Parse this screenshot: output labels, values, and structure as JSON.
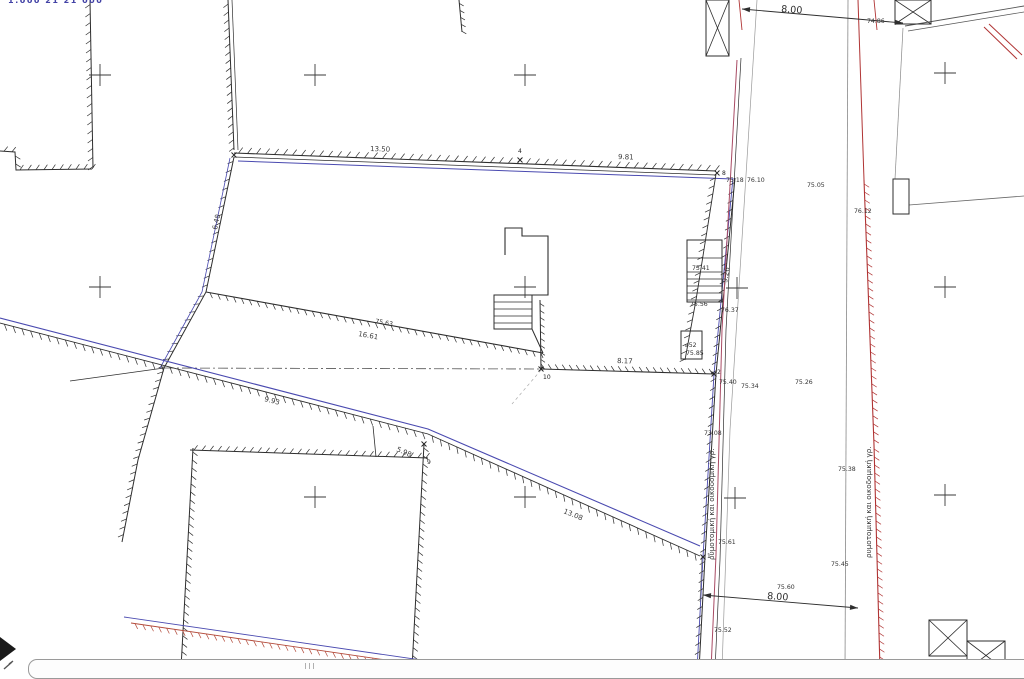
{
  "canvas": {
    "width": 1024,
    "height": 670,
    "background": "#ffffff"
  },
  "corner_text": "1:000 21 21 000",
  "street_labels": {
    "left": "ρυμοτομική και οικοδομική γρ.",
    "right": "ρυμοτομική και οικοδομική γρ."
  },
  "colors": {
    "ink": "#2e2e2e",
    "boundary_blue": "#4a4ab0",
    "road_magenta": "#a84a63",
    "edge_red": "#b03434",
    "bottom_red": "#b34a3a",
    "faint_gray": "#999999",
    "cross_gray": "#3a3a3a"
  },
  "labels": [
    {
      "text": "13.50",
      "x": 370,
      "y": 151,
      "rot": 2,
      "kind": "dim"
    },
    {
      "text": "9.81",
      "x": 618,
      "y": 159,
      "rot": 2,
      "kind": "dim"
    },
    {
      "text": "6.40",
      "x": 217,
      "y": 230,
      "rot": -78,
      "kind": "dim"
    },
    {
      "text": "9.26",
      "x": 727,
      "y": 283,
      "rot": -80,
      "kind": "dim"
    },
    {
      "text": "16.61",
      "x": 358,
      "y": 336,
      "rot": 10,
      "kind": "dim"
    },
    {
      "text": "8.17",
      "x": 617,
      "y": 363,
      "rot": 2,
      "kind": "dim"
    },
    {
      "text": "9.93",
      "x": 264,
      "y": 401,
      "rot": 14,
      "kind": "dim"
    },
    {
      "text": "5.98",
      "x": 396,
      "y": 451,
      "rot": 23,
      "kind": "dim"
    },
    {
      "text": "13.08",
      "x": 563,
      "y": 513,
      "rot": 22,
      "kind": "dim"
    },
    {
      "text": "8.00",
      "x": 781,
      "y": 12,
      "rot": 4,
      "kind": "big"
    },
    {
      "text": "8.00",
      "x": 767,
      "y": 599,
      "rot": 4,
      "kind": "big"
    },
    {
      "text": "74.86",
      "x": 867,
      "y": 23,
      "rot": 0,
      "kind": "elev"
    },
    {
      "text": "75.18",
      "x": 726,
      "y": 182,
      "rot": 0,
      "kind": "elev"
    },
    {
      "text": "76.10",
      "x": 747,
      "y": 182,
      "rot": 0,
      "kind": "elev"
    },
    {
      "text": "75.05",
      "x": 807,
      "y": 187,
      "rot": 0,
      "kind": "elev"
    },
    {
      "text": "76.12",
      "x": 854,
      "y": 213,
      "rot": 0,
      "kind": "elev"
    },
    {
      "text": "75.41",
      "x": 692,
      "y": 270,
      "rot": 0,
      "kind": "elev"
    },
    {
      "text": "75.56",
      "x": 690,
      "y": 306,
      "rot": 0,
      "kind": "elev"
    },
    {
      "text": "76.37",
      "x": 721,
      "y": 312,
      "rot": 0,
      "kind": "elev"
    },
    {
      "text": "75.63",
      "x": 375,
      "y": 323,
      "rot": 10,
      "kind": "elev"
    },
    {
      "text": "⌀52",
      "x": 685,
      "y": 347,
      "rot": 0,
      "kind": "elev"
    },
    {
      "text": "75.85",
      "x": 686,
      "y": 355,
      "rot": 0,
      "kind": "elev"
    },
    {
      "text": "75.40",
      "x": 719,
      "y": 384,
      "rot": 0,
      "kind": "elev"
    },
    {
      "text": "75.34",
      "x": 741,
      "y": 388,
      "rot": 0,
      "kind": "elev"
    },
    {
      "text": "75.26",
      "x": 795,
      "y": 384,
      "rot": 0,
      "kind": "elev"
    },
    {
      "text": "73.08",
      "x": 704,
      "y": 435,
      "rot": 0,
      "kind": "elev"
    },
    {
      "text": "75.38",
      "x": 838,
      "y": 471,
      "rot": 0,
      "kind": "elev"
    },
    {
      "text": "75.61",
      "x": 718,
      "y": 544,
      "rot": 0,
      "kind": "elev"
    },
    {
      "text": "75.45",
      "x": 831,
      "y": 566,
      "rot": 0,
      "kind": "elev"
    },
    {
      "text": "75.60",
      "x": 777,
      "y": 589,
      "rot": 0,
      "kind": "elev"
    },
    {
      "text": "75.52",
      "x": 714,
      "y": 632,
      "rot": 0,
      "kind": "elev"
    },
    {
      "text": "4",
      "x": 518,
      "y": 153,
      "rot": 0,
      "kind": "pt"
    },
    {
      "text": "8",
      "x": 722,
      "y": 175,
      "rot": 0,
      "kind": "pt"
    },
    {
      "text": "10",
      "x": 543,
      "y": 379,
      "rot": 0,
      "kind": "pt"
    },
    {
      "text": "2",
      "x": 717,
      "y": 374,
      "rot": 0,
      "kind": "pt"
    },
    {
      "text": "9",
      "x": 427,
      "y": 464,
      "rot": 0,
      "kind": "pt"
    },
    {
      "text": "1",
      "x": 707,
      "y": 558,
      "rot": 0,
      "kind": "pt"
    }
  ],
  "grid_crosses": [
    [
      100,
      75
    ],
    [
      315,
      75
    ],
    [
      525,
      75
    ],
    [
      945,
      73
    ],
    [
      100,
      287
    ],
    [
      525,
      287
    ],
    [
      737,
      288
    ],
    [
      945,
      287
    ],
    [
      315,
      497
    ],
    [
      525,
      497
    ],
    [
      735,
      498
    ],
    [
      945,
      495
    ]
  ],
  "point_markers": [
    [
      234,
      155
    ],
    [
      520,
      160
    ],
    [
      717,
      173
    ],
    [
      541,
      369
    ],
    [
      714,
      374
    ],
    [
      424,
      444
    ],
    [
      703,
      557
    ]
  ]
}
